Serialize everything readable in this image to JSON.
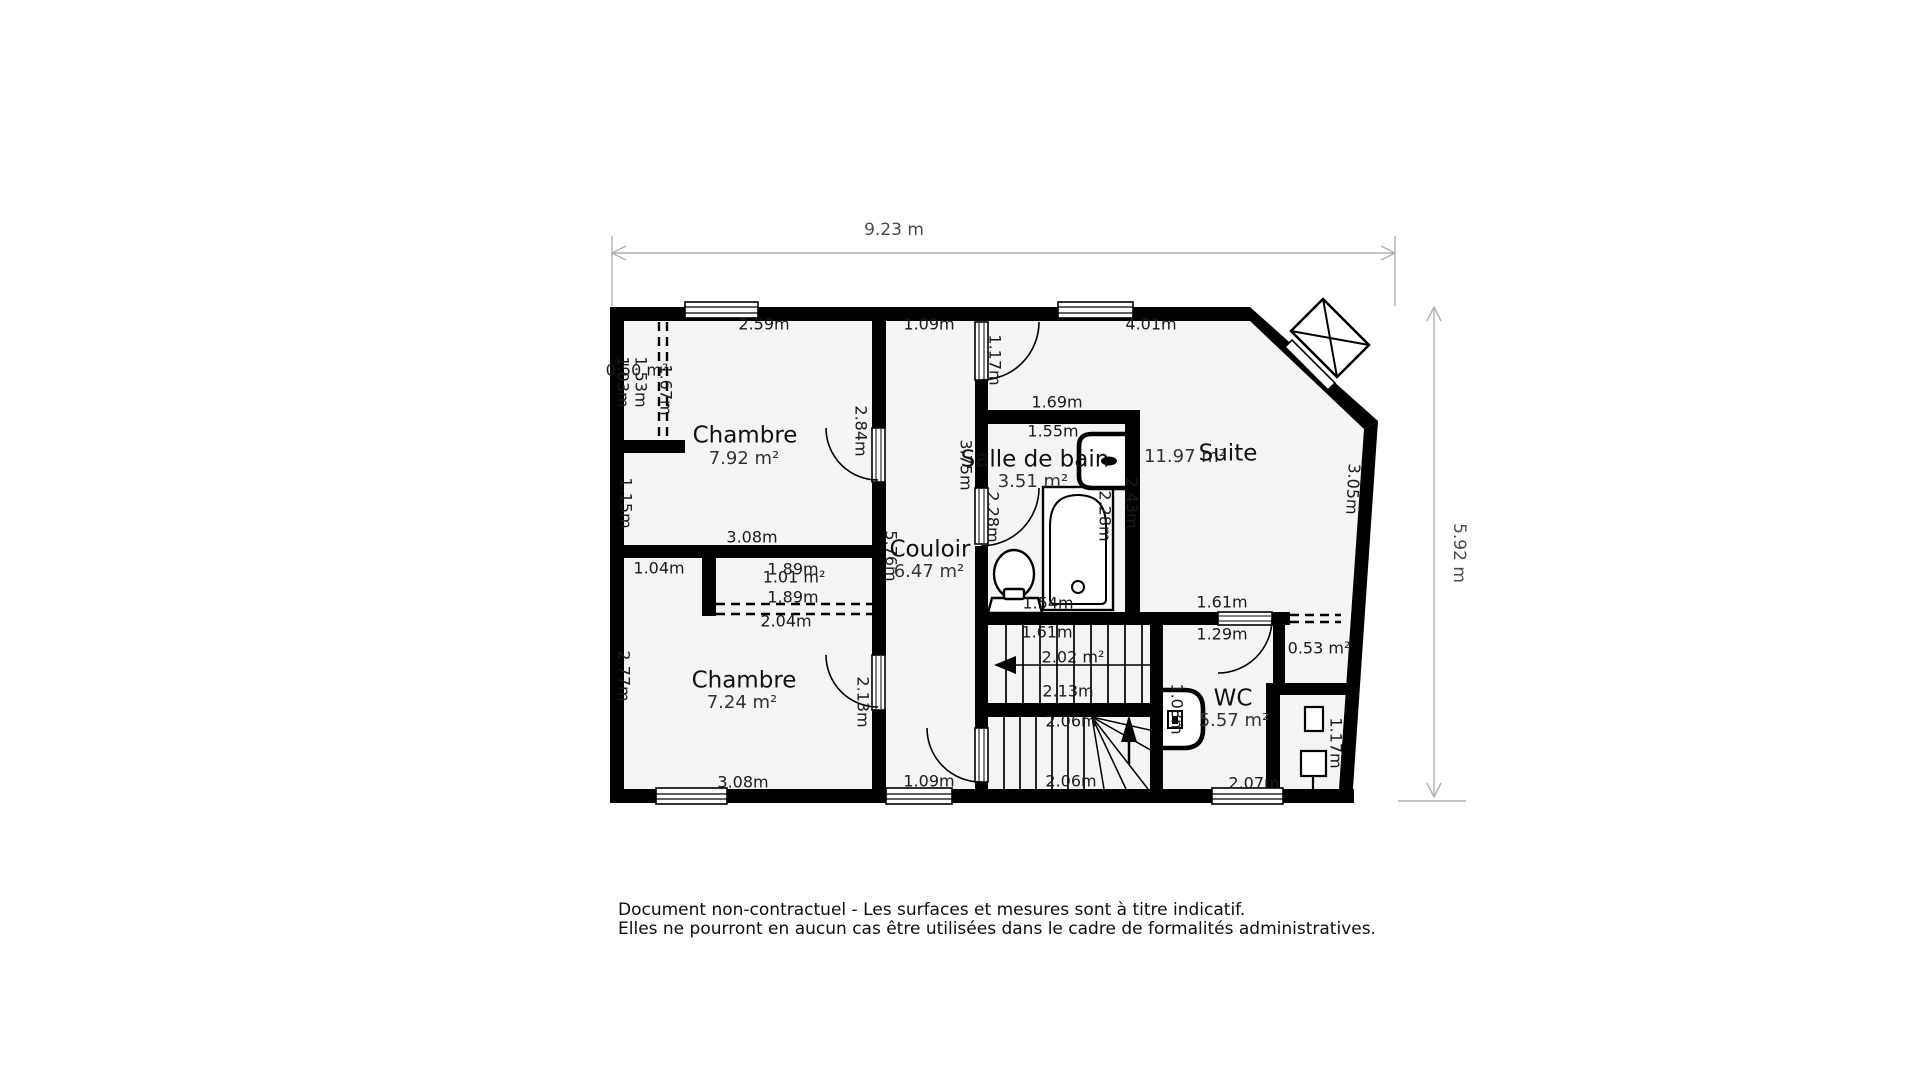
{
  "plan_title": "floor-plan",
  "overall_dimensions": {
    "width": "9.23 m",
    "height": "5.92 m"
  },
  "rooms": [
    {
      "id": "chambre-1",
      "label": "Chambre",
      "area": "7.92 m²"
    },
    {
      "id": "chambre-2",
      "label": "Chambre",
      "area": "7.24 m²"
    },
    {
      "id": "couloir",
      "label": "Couloir",
      "area": "6.47 m²"
    },
    {
      "id": "salle-de-bain",
      "label": "Salle de bain",
      "area": "3.51 m²"
    },
    {
      "id": "suite",
      "label": "Suite",
      "area": "11.97 m²"
    },
    {
      "id": "wc",
      "label": "WC",
      "area": "5.57 m²"
    },
    {
      "id": "placard-chambre-1",
      "label": "",
      "area": "0.50 m²"
    },
    {
      "id": "placard-chambre-2",
      "label": "",
      "area": "1.01 m²"
    },
    {
      "id": "placard-suite",
      "label": "",
      "area": "0.53 m²"
    },
    {
      "id": "escalier",
      "label": "",
      "area": "2.02 m²"
    }
  ],
  "colors": {
    "wall": "#000000",
    "floor": "#f4f4f4",
    "dim_line": "#b0b0b0",
    "dim_text": "#4a4a4a",
    "label_text": "#1a1a1a"
  },
  "disclaimer": {
    "line1": "Document non-contractuel - Les surfaces et mesures sont à titre indicatif.",
    "line2": "Elles ne pourront en aucun cas être utilisées dans le cadre de formalités administratives."
  },
  "labels": [
    {
      "t": "9.23 m",
      "x": 894,
      "y": 230,
      "r": 0,
      "k": "dim",
      "n": "overall-width-label"
    },
    {
      "t": "5.92 m",
      "x": 1459,
      "y": 553,
      "r": 90,
      "k": "dim",
      "n": "overall-height-label"
    },
    {
      "t": "Chambre",
      "x": 745,
      "y": 436,
      "r": 0,
      "k": "rt",
      "n": "room-title-chambre-1"
    },
    {
      "t": "7.92 m²",
      "x": 744,
      "y": 459,
      "r": 0,
      "k": "ra",
      "n": "room-area-chambre-1"
    },
    {
      "t": "Chambre",
      "x": 744,
      "y": 681,
      "r": 0,
      "k": "rt",
      "n": "room-title-chambre-2"
    },
    {
      "t": "7.24 m²",
      "x": 742,
      "y": 703,
      "r": 0,
      "k": "ra",
      "n": "room-area-chambre-2"
    },
    {
      "t": "Couloir",
      "x": 930,
      "y": 550,
      "r": 0,
      "k": "rt",
      "n": "room-title-couloir"
    },
    {
      "t": "6.47 m²",
      "x": 929,
      "y": 572,
      "r": 0,
      "k": "ra",
      "n": "room-area-couloir"
    },
    {
      "t": "Salle de bain",
      "x": 1035,
      "y": 460,
      "r": 0,
      "k": "rt",
      "n": "room-title-salle-de-bain"
    },
    {
      "t": "3.51 m²",
      "x": 1033,
      "y": 482,
      "r": 0,
      "k": "ra",
      "n": "room-area-salle-de-bain"
    },
    {
      "t": "11.97 m²",
      "x": 1185,
      "y": 457,
      "r": 0,
      "k": "ra",
      "n": "room-area-suite"
    },
    {
      "t": "Suite",
      "x": 1228,
      "y": 454,
      "r": 0,
      "k": "rt",
      "n": "room-title-suite"
    },
    {
      "t": "WC",
      "x": 1233,
      "y": 699,
      "r": 0,
      "k": "rt",
      "n": "room-title-wc"
    },
    {
      "t": "5.57 m²",
      "x": 1234,
      "y": 721,
      "r": 0,
      "k": "ra",
      "n": "room-area-wc"
    },
    {
      "t": "2.59m",
      "x": 764,
      "y": 325,
      "r": 0,
      "k": "m"
    },
    {
      "t": "1.09m",
      "x": 929,
      "y": 325,
      "r": 0,
      "k": "m"
    },
    {
      "t": "4.01m",
      "x": 1151,
      "y": 325,
      "r": 0,
      "k": "m"
    },
    {
      "t": "1.17m",
      "x": 994,
      "y": 360,
      "r": 90,
      "k": "m"
    },
    {
      "t": "1.69m",
      "x": 1057,
      "y": 403,
      "r": 0,
      "k": "m"
    },
    {
      "t": "1.55m",
      "x": 1053,
      "y": 432,
      "r": 0,
      "k": "m"
    },
    {
      "t": "0.50 m²",
      "x": 637,
      "y": 371,
      "r": 0,
      "k": "m"
    },
    {
      "t": "1.03m",
      "x": 622,
      "y": 382,
      "r": 90,
      "k": "m"
    },
    {
      "t": "1.53m",
      "x": 640,
      "y": 382,
      "r": 90,
      "k": "m"
    },
    {
      "t": "1.67m",
      "x": 665,
      "y": 390,
      "r": 90,
      "k": "m"
    },
    {
      "t": "2.84m",
      "x": 860,
      "y": 431,
      "r": 90,
      "k": "m"
    },
    {
      "t": "3.75m",
      "x": 965,
      "y": 465,
      "r": 90,
      "k": "m"
    },
    {
      "t": "2.28m",
      "x": 992,
      "y": 517,
      "r": 90,
      "k": "m"
    },
    {
      "t": "2.28m",
      "x": 1104,
      "y": 516,
      "r": 90,
      "k": "m"
    },
    {
      "t": "2.43m",
      "x": 1131,
      "y": 503,
      "r": 90,
      "k": "m"
    },
    {
      "t": "3.05m",
      "x": 1352,
      "y": 489,
      "r": 93,
      "k": "m"
    },
    {
      "t": "1.15m",
      "x": 625,
      "y": 503,
      "r": 90,
      "k": "m"
    },
    {
      "t": "3.08m",
      "x": 752,
      "y": 538,
      "r": 0,
      "k": "m"
    },
    {
      "t": "5.76m",
      "x": 890,
      "y": 556,
      "r": 90,
      "k": "m"
    },
    {
      "t": "1.04m",
      "x": 659,
      "y": 569,
      "r": 0,
      "k": "m"
    },
    {
      "t": "1.89m",
      "x": 793,
      "y": 570,
      "r": 0,
      "k": "m"
    },
    {
      "t": "1.01 m²",
      "x": 794,
      "y": 578,
      "r": 0,
      "k": "m"
    },
    {
      "t": "1.89m",
      "x": 793,
      "y": 598,
      "r": 0,
      "k": "m"
    },
    {
      "t": "2.04m",
      "x": 786,
      "y": 622,
      "r": 0,
      "k": "m"
    },
    {
      "t": "1.54m",
      "x": 1048,
      "y": 604,
      "r": 0,
      "k": "m"
    },
    {
      "t": "1.61m",
      "x": 1222,
      "y": 603,
      "r": 0,
      "k": "m"
    },
    {
      "t": "1.29m",
      "x": 1222,
      "y": 635,
      "r": 0,
      "k": "m"
    },
    {
      "t": "0.53 m²",
      "x": 1319,
      "y": 649,
      "r": 0,
      "k": "m"
    },
    {
      "t": "1.61m",
      "x": 1047,
      "y": 633,
      "r": 0,
      "k": "m"
    },
    {
      "t": "2.02 m²",
      "x": 1073,
      "y": 658,
      "r": 0,
      "k": "m"
    },
    {
      "t": "2.13m",
      "x": 1068,
      "y": 692,
      "r": 0,
      "k": "m"
    },
    {
      "t": "2.06m",
      "x": 1071,
      "y": 722,
      "r": 0,
      "k": "m"
    },
    {
      "t": "2.06m",
      "x": 1071,
      "y": 782,
      "r": 0,
      "k": "m"
    },
    {
      "t": "2.77m",
      "x": 623,
      "y": 676,
      "r": 90,
      "k": "m"
    },
    {
      "t": "2.13m",
      "x": 862,
      "y": 702,
      "r": 90,
      "k": "m"
    },
    {
      "t": "1.08m",
      "x": 1176,
      "y": 709,
      "r": 90,
      "k": "m"
    },
    {
      "t": "1.17m",
      "x": 1335,
      "y": 743,
      "r": 90,
      "k": "m"
    },
    {
      "t": "3.08m",
      "x": 743,
      "y": 783,
      "r": 0,
      "k": "m"
    },
    {
      "t": "1.09m",
      "x": 929,
      "y": 782,
      "r": 0,
      "k": "m"
    },
    {
      "t": "2.07m",
      "x": 1254,
      "y": 784,
      "r": 0,
      "k": "m"
    }
  ]
}
